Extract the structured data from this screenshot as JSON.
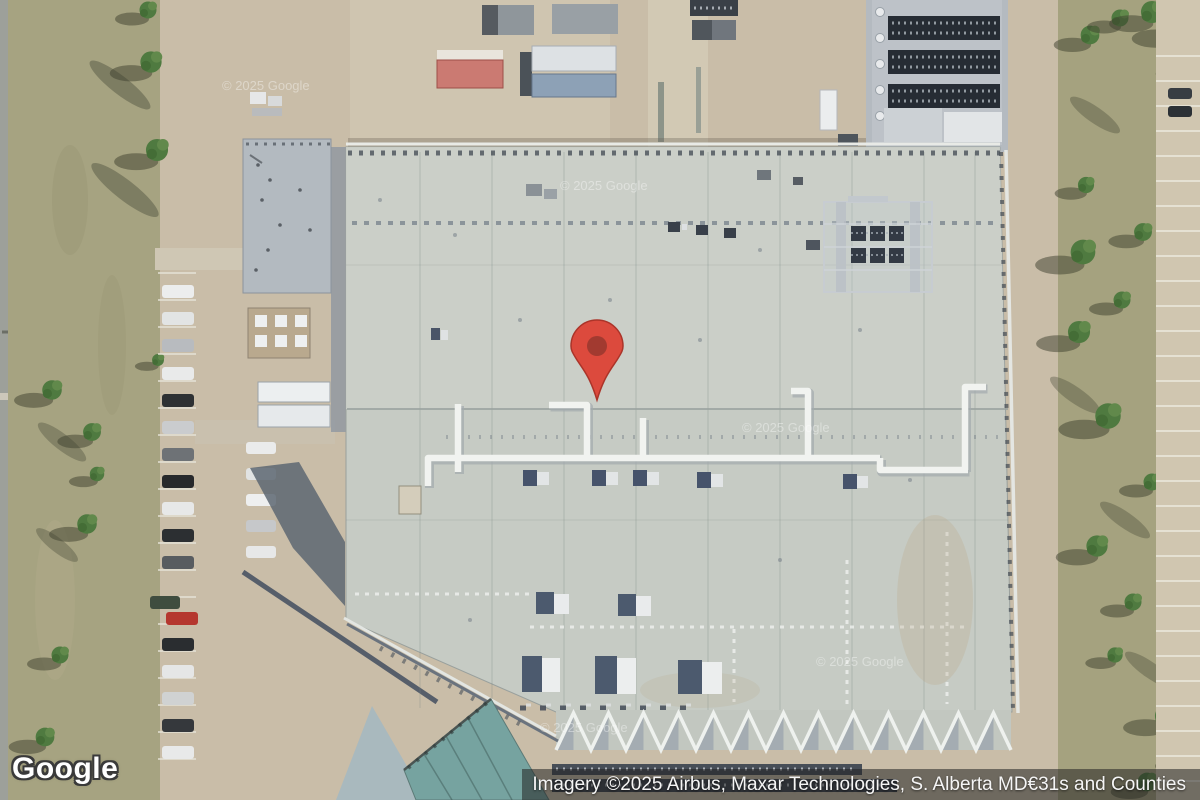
{
  "branding": {
    "logo_text": "Google"
  },
  "attribution": {
    "text": "Imagery ©2025 Airbus, Maxar Technologies, S. Alberta MD€31s and Counties"
  },
  "watermarks": {
    "items": [
      "© 2025 Google",
      "© 2025 Google",
      "© 2025 Google",
      "© 2025 Google",
      "© 2025 Google"
    ]
  },
  "marker": {
    "icon": "dropped-pin",
    "body_color": "#dc4a3d",
    "inner_color": "#a23a30"
  },
  "palette": {
    "main_roof": "#c6cbc4",
    "annex_roof": "#b3bac0",
    "teal_roof": "#76a3a0",
    "grass": "#a6a381",
    "dirt": "#c9bda8",
    "road": "#9da09a",
    "tree": "#4f7a40",
    "duct_white": "#f1f3f0",
    "hvac_dark": "#46536b",
    "attribution_bg": "rgba(34,34,34,0.54)"
  }
}
